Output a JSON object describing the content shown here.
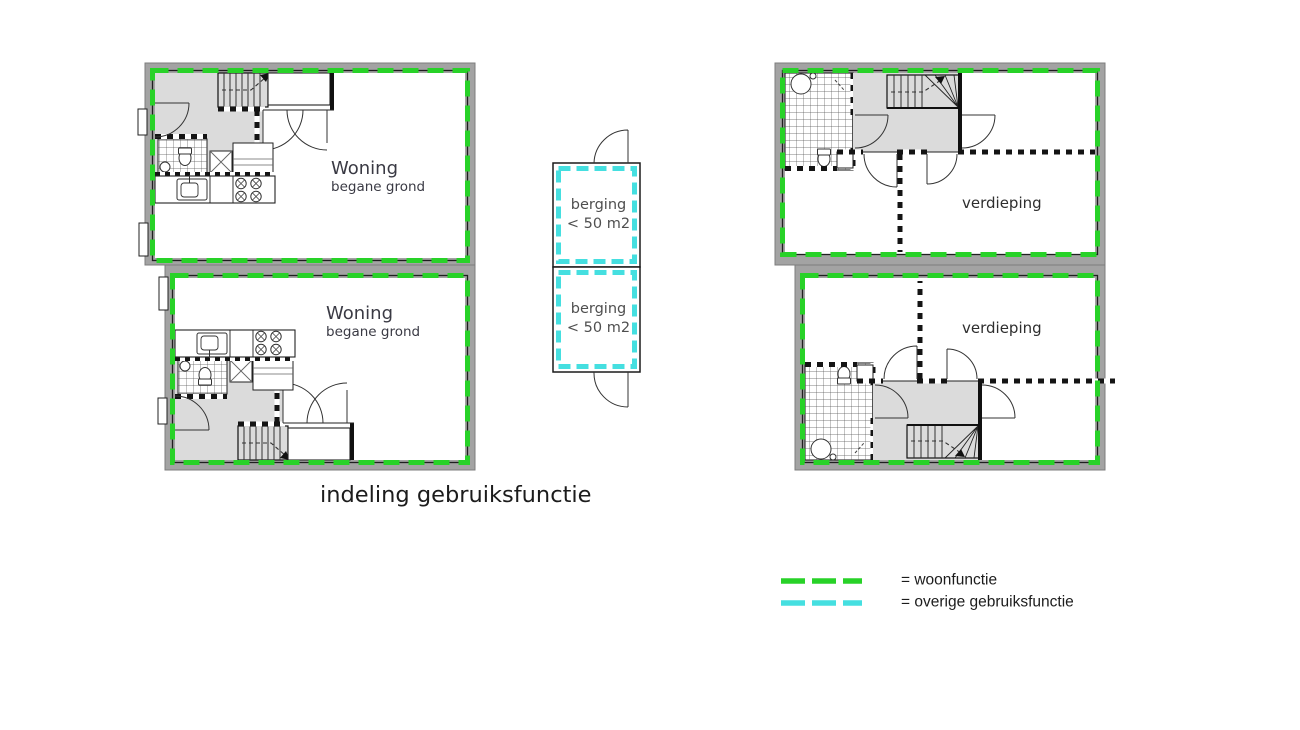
{
  "title": "indeling gebruiksfunctie",
  "colors": {
    "woonfunctie": "#28d228",
    "overige": "#45dfe0",
    "wall_gray": "#a3a3a3",
    "hall_gray": "#dbdbdb"
  },
  "plans": {
    "woning_top": {
      "name": "Woning",
      "floor": "begane grond"
    },
    "woning_bottom": {
      "name": "Woning",
      "floor": "begane grond"
    },
    "verdieping_top": {
      "label": "verdieping"
    },
    "verdieping_bottom": {
      "label": "verdieping"
    },
    "berging_top": {
      "line1": "berging",
      "line2": "< 50 m2"
    },
    "berging_bottom": {
      "line1": "berging",
      "line2": "< 50 m2"
    }
  },
  "legend": {
    "woonfunctie": {
      "label": "= woonfunctie",
      "color": "#28d228"
    },
    "overige": {
      "label": "= overige gebruiksfunctie",
      "color": "#45dfe0"
    }
  }
}
